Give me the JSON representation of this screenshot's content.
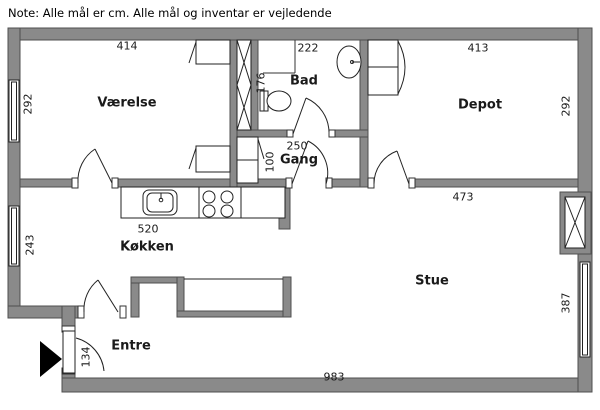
{
  "note": "Note: Alle mål er cm. Alle mål og inventar er vejledende",
  "rooms": {
    "vaerelse": "Værelse",
    "bad": "Bad",
    "depot": "Depot",
    "gang": "Gang",
    "koekken": "Køkken",
    "stue": "Stue",
    "entre": "Entre"
  },
  "dimensions": {
    "vaerelse_width": "414",
    "vaerelse_height": "292",
    "bad_width": "222",
    "bad_height": "176",
    "depot_width": "413",
    "depot_height": "292",
    "gang_width": "250",
    "gang_height": "100",
    "koekken_counter": "520",
    "koekken_height": "243",
    "stue_width": "473",
    "stue_height": "387",
    "entre_door": "134",
    "total_width": "983"
  },
  "colors": {
    "wall": "#8a8a8a",
    "wall_outline": "#4f4f4f",
    "line": "#222222"
  }
}
